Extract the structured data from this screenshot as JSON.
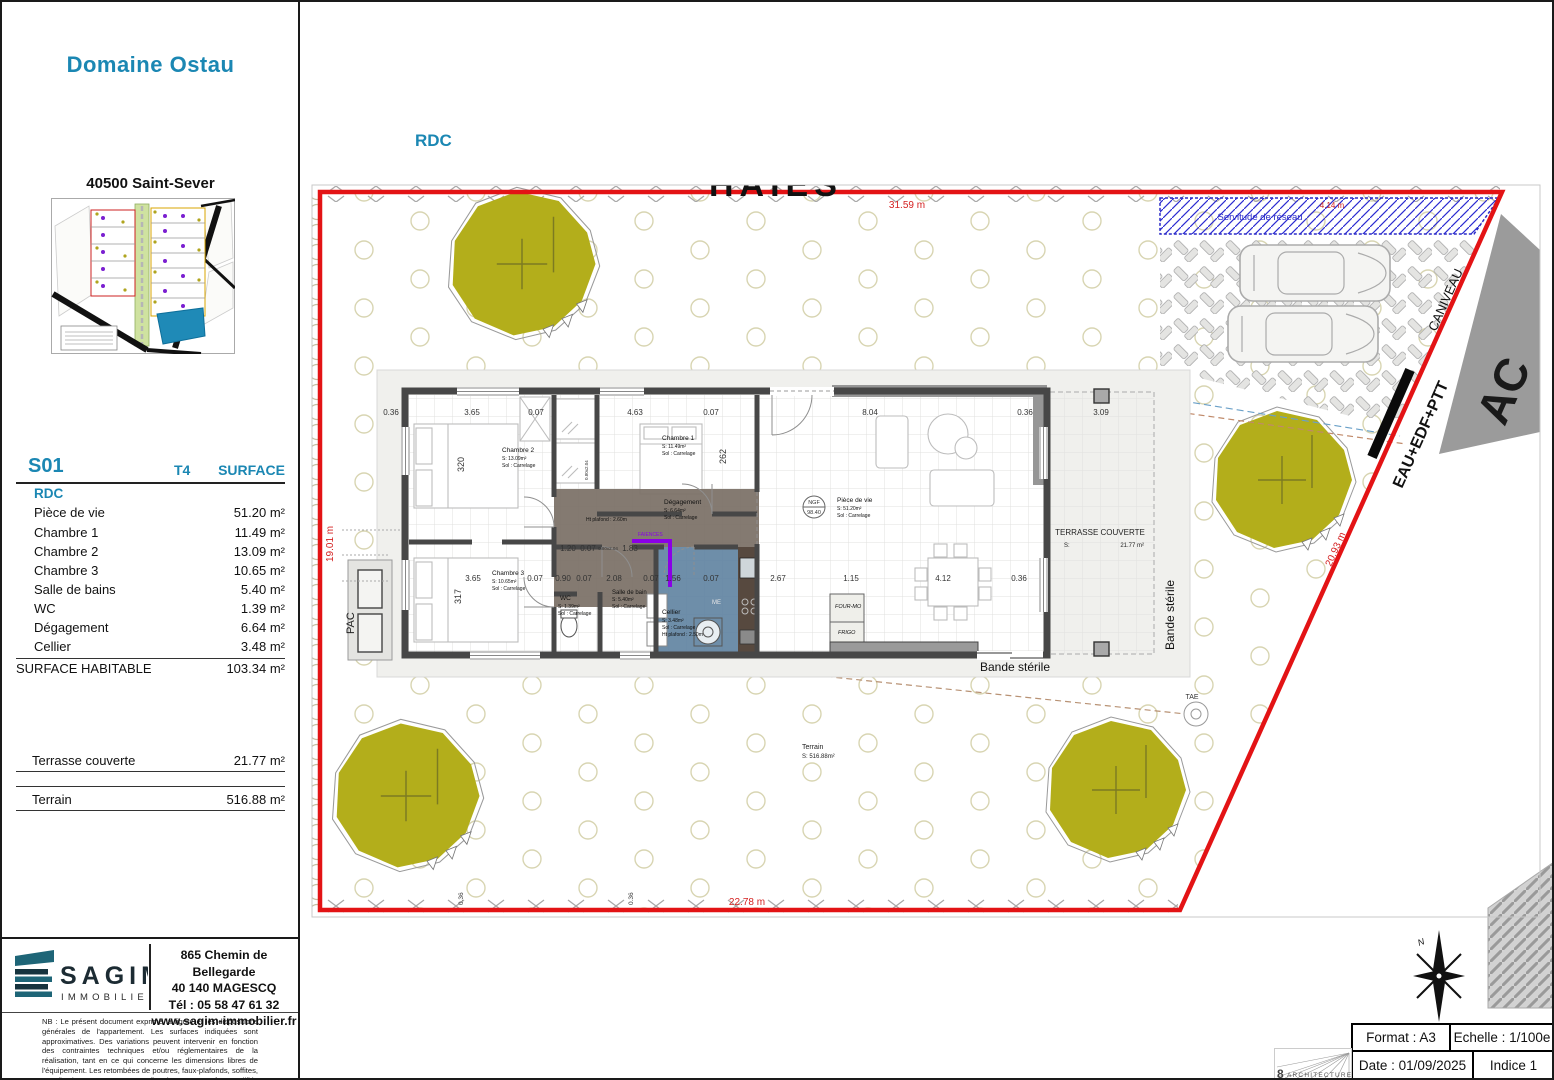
{
  "accent": "#1b87b3",
  "sidebar": {
    "project_title": "Domaine Ostau",
    "location": "40500 Saint-Sever",
    "surface_table": {
      "lot": "S01",
      "type": "T4",
      "col_surface": "SURFACE",
      "level": "RDC",
      "rows": [
        {
          "label": "Pièce de vie",
          "value": "51.20 m²"
        },
        {
          "label": "Chambre 1",
          "value": "11.49 m²"
        },
        {
          "label": "Chambre 2",
          "value": "13.09 m²"
        },
        {
          "label": "Chambre 3",
          "value": "10.65 m²"
        },
        {
          "label": "Salle de bains",
          "value": "5.40 m²"
        },
        {
          "label": "WC",
          "value": "1.39 m²"
        },
        {
          "label": "Dégagement",
          "value": "6.64 m²"
        },
        {
          "label": "Cellier",
          "value": "3.48 m²"
        }
      ],
      "total_label": "SURFACE HABITABLE",
      "total_value": "103.34 m²",
      "terrace_label": "Terrasse couverte",
      "terrace_value": "21.77 m²",
      "terrain_label": "Terrain",
      "terrain_value": "516.88 m²"
    },
    "agency": {
      "name": "SAGIM",
      "subtitle": "IMMOBILIER",
      "address1": "865 Chemin de Bellegarde",
      "address2": "40 140 MAGESCQ",
      "phone": "Tél : 05 58 47 61 32",
      "website": "www.sagim-immobilier.fr"
    },
    "disclaimer": "NB : Le présent document exprime la figure et les dispositions générales de l'appartement. Les surfaces indiquées sont approximatives. Des variations peuvent intervenir en fonction des contraintes techniques et/ou réglementaires de la réalisation, tant en ce qui concerne les dimensions libres de l'équipement. Les retombées de poutres, faux-plafonds, soffites, canalisations, ne sont pas tous figurés et peuvent être modifiés pour des raisons techniques. Les éléments de mobiliers de cuisine et les implantations des équipements électriques sont présentés à titre indicatif et ne sont pas contractuels. Les éventuelles plantations dans les jardins privatifs ou espace verts sont représentés à titre indicatif."
  },
  "plan": {
    "level_label": "RDC",
    "haies": "HAIES",
    "servitude": "Servitude de réseau",
    "caniveau": "CANIVEAU",
    "utilities": "EAU+EDF+PTT",
    "road_letters": "AC",
    "bande_sterile_h": "Bande stérile",
    "bande_sterile_v": "Bande stérile",
    "pac": "PAC",
    "tae": "TAE",
    "ngf1": "NGF",
    "ngf2": "98.40",
    "terrain_label": "Terrain",
    "terrain_area": "S: 516.88m²",
    "terrace_label": "TERRASSE COUVERTE",
    "terrace_s": "S:",
    "terrace_area": "21.77 m²",
    "ceiling_note": "Ht plafond : 2.60m",
    "door_size": "0.80x2.04",
    "faience": "FAIENCES",
    "compass_n": "N",
    "dims": {
      "top_total": "31.59 m",
      "left_total": "19.01 m",
      "bottom_total": "22.78 m",
      "diag_total": "20.93 m",
      "drive": "6.81 m",
      "servitude_len": "4.14 m"
    },
    "rooms": [
      {
        "name": "Chambre 2",
        "area": "S: 13.09m²",
        "floor": "Sol : Carrelage"
      },
      {
        "name": "Chambre 1",
        "area": "S: 11.49m²",
        "floor": "Sol : Carrelage"
      },
      {
        "name": "Chambre 3",
        "area": "S: 10.65m²",
        "floor": "Sol : Carrelage"
      },
      {
        "name": "Dégagement",
        "area": "S: 6.64m²",
        "floor": "Sol : Carrelage"
      },
      {
        "name": "WC",
        "area": "S: 1.39m²",
        "floor": "Sol : Carrelage"
      },
      {
        "name": "Salle de bain",
        "area": "S: 5.40m²",
        "floor": "Sol : Carrelage"
      },
      {
        "name": "Cellier",
        "area": "S: 3.48m²",
        "floor": "Sol : Carrelage",
        "height": "Ht plafond : 2.50m"
      },
      {
        "name": "Pièce de vie",
        "area": "S: 51.20m²",
        "floor": "Sol : Carrelage"
      }
    ],
    "appliances": {
      "four": "FOUR-MO",
      "frigo": "FRIGO",
      "me": "ME"
    },
    "dims_top": [
      "0.36",
      "3.65",
      "0.07",
      "4.63",
      "0.07",
      "8.04",
      "0.36",
      "3.09"
    ],
    "dims_mid": [
      "3.65",
      "0.07",
      "0.90",
      "0.07",
      "2.08",
      "0.07",
      "1.56",
      "0.07",
      "2.67",
      "1.15",
      "4.12",
      "0.36"
    ],
    "dims_corridor": [
      "1.20",
      "0.07",
      "1.83"
    ],
    "dims_vert": [
      "320",
      "262",
      "317"
    ],
    "dims_bottom_small": [
      "0.36",
      "0.36"
    ]
  },
  "titleblock": {
    "format": "Format : A3",
    "scale": "Echelle : 1/100e",
    "date": "Date : 01/09/2025",
    "indice": "Indice 1",
    "firm_number": "8",
    "firm_name": "ARCHITECTURE"
  }
}
